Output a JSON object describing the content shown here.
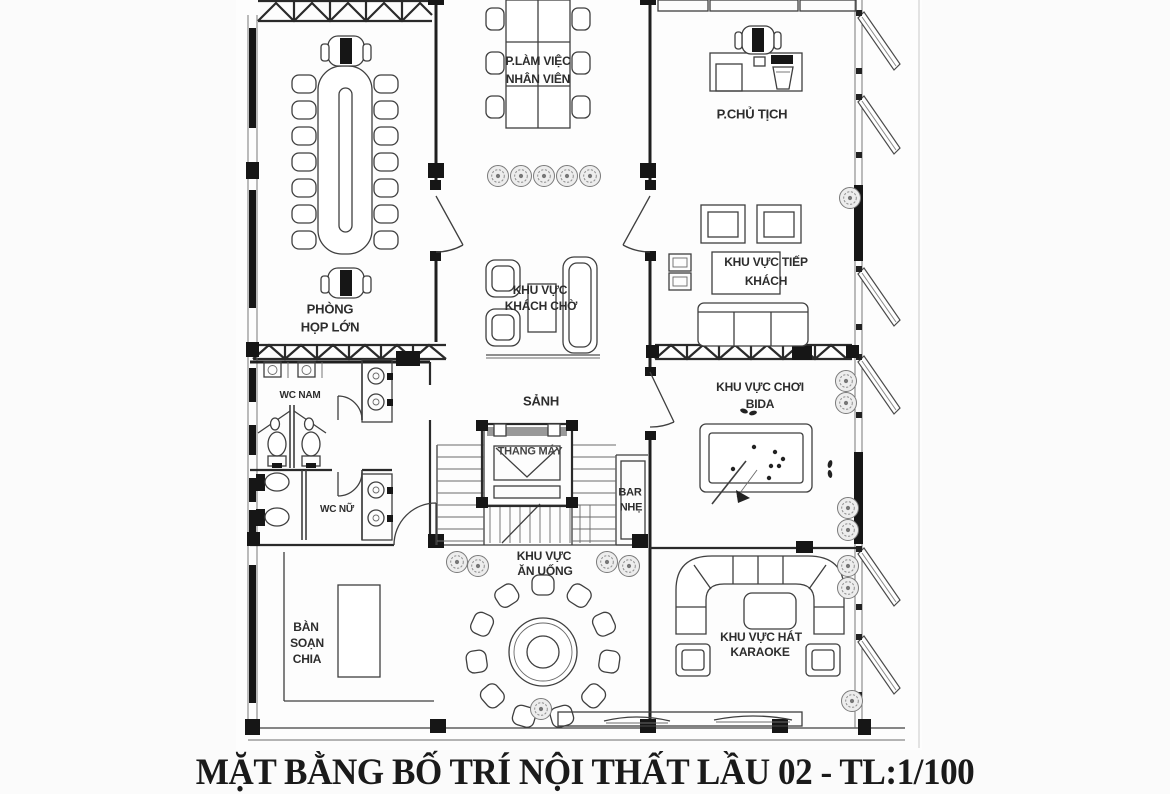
{
  "document": {
    "title": "MẶT BẰNG BỐ TRÍ NỘI THẤT LẦU 02 - TL:1/100"
  },
  "rooms": {
    "meeting_room": {
      "lines": [
        "PHÒNG",
        "HỌP LỚN"
      ]
    },
    "staff_office": {
      "lines": [
        "P.LÀM VIỆC",
        "NHÂN VIÊN"
      ]
    },
    "chairman_office": {
      "lines": [
        "P.CHỦ TỊCH"
      ]
    },
    "waiting_area": {
      "lines": [
        "KHU VỰC",
        "KHÁCH CHỜ"
      ]
    },
    "reception_area": {
      "lines": [
        "KHU VỰC TIẾP",
        "KHÁCH"
      ]
    },
    "lobby": {
      "lines": [
        "SẢNH"
      ]
    },
    "elevator": {
      "lines": [
        "THANG MÁY"
      ]
    },
    "bar": {
      "lines": [
        "BAR",
        "NHẸ"
      ]
    },
    "billiards_area": {
      "lines": [
        "KHU VỰC CHƠI",
        "BIDA"
      ]
    },
    "wc_men": {
      "lines": [
        "WC NAM"
      ]
    },
    "wc_women": {
      "lines": [
        "WC NỮ"
      ]
    },
    "dining_area": {
      "lines": [
        "KHU VỰC",
        "ĂN UỐNG"
      ]
    },
    "serving_table": {
      "lines": [
        "BÀN",
        "SOẠN",
        "CHIA"
      ]
    },
    "karaoke_area": {
      "lines": [
        "KHU VỰC HÁT",
        "KARAOKE"
      ]
    }
  },
  "colors": {
    "ink": "#3f3f3f",
    "wall": "#1f1f1f",
    "paper": "#fdfdfd"
  }
}
